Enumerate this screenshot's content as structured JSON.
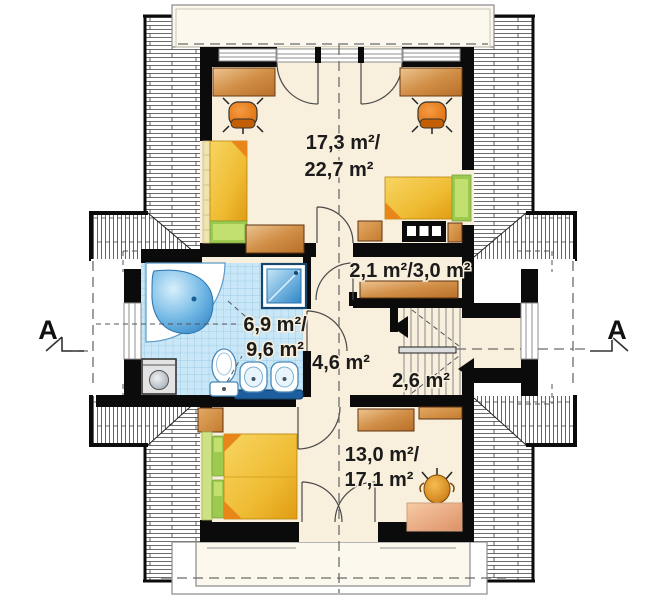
{
  "floor_plan": {
    "view": "attic-storey-floor-plan",
    "rooms": [
      {
        "id": "bedroom-top",
        "label_line1": "17,3 m²/",
        "label_line2": "22,7 m²"
      },
      {
        "id": "wardrobe",
        "label_line1": "2,1 m²/3,0 m²"
      },
      {
        "id": "bathroom",
        "label_line1": "6,9 m²/",
        "label_line2": "9,6 m²"
      },
      {
        "id": "hall",
        "label_line1": "4,6 m²"
      },
      {
        "id": "staircase",
        "label_line1": "2,6 m²"
      },
      {
        "id": "bedroom-bottom",
        "label_line1": "13,0 m²/",
        "label_line2": "17,1 m²"
      }
    ],
    "section_marks": {
      "left": "A",
      "right": "A"
    },
    "furniture": [
      "desk",
      "office-chair",
      "single-bed",
      "double-bed",
      "wardrobe-shelf",
      "dresser",
      "corner-bathtub",
      "shower",
      "washing-machine",
      "toilet",
      "washbasin",
      "counter",
      "rug",
      "plant-pot",
      "stairs"
    ],
    "colors": {
      "floor": "#F8EFDC",
      "wall": "#0b0b0b",
      "tile": "#C9E7F7",
      "tile_grid": "#8FC4E0",
      "fixture_blue": "#2E86C8",
      "counter_navy": "#1D5E9E",
      "wood": "#C97F36",
      "wood_light": "#EBBE8A",
      "bed_yellow": "#F2C94C",
      "bed_orange": "#E8961C",
      "green": "#9CC94E",
      "green_light": "#CDE284",
      "chair_orange": "#E87E1E",
      "rug": "#EFAF85",
      "text": "#1b1b1b"
    }
  }
}
